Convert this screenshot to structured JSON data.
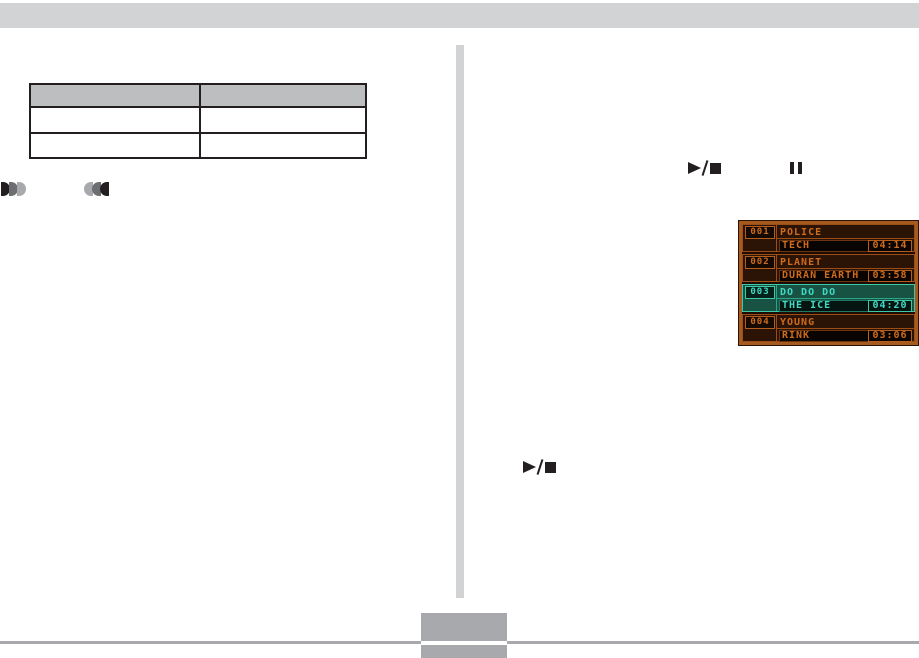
{
  "page": {
    "top_bar_color": "#d1d3d4",
    "divider_color": "#d1d3d4",
    "footer_color": "#a7a9ac"
  },
  "table": {
    "header_fill": "#bcbec0",
    "columns": [
      "",
      ""
    ],
    "rows": [
      [
        "",
        ""
      ],
      [
        "",
        ""
      ]
    ]
  },
  "icons": {
    "fast_forward": "fast-forward-icon",
    "rewind": "rewind-icon",
    "play_stop": "play/stop",
    "pause": "pause"
  },
  "player": {
    "frame_color": "#a55a1e",
    "screen_bg": "#1c0c03",
    "text_color": "#cf6b1c",
    "selected_text_color": "#3fd9c4",
    "selected_bg": "#175243",
    "selected_border": "#3cc9a7",
    "tracks": [
      {
        "number": "001",
        "title": "POLICE",
        "artist": "TECH",
        "time": "04:14",
        "selected": false
      },
      {
        "number": "002",
        "title": "PLANET",
        "artist": "DURAN EARTH",
        "time": "03:58",
        "selected": false
      },
      {
        "number": "003",
        "title": "DO DO DO",
        "artist": "THE ICE",
        "time": "04:20",
        "selected": true
      },
      {
        "number": "004",
        "title": "YOUNG",
        "artist": "RINK",
        "time": "03:06",
        "selected": false
      }
    ]
  }
}
